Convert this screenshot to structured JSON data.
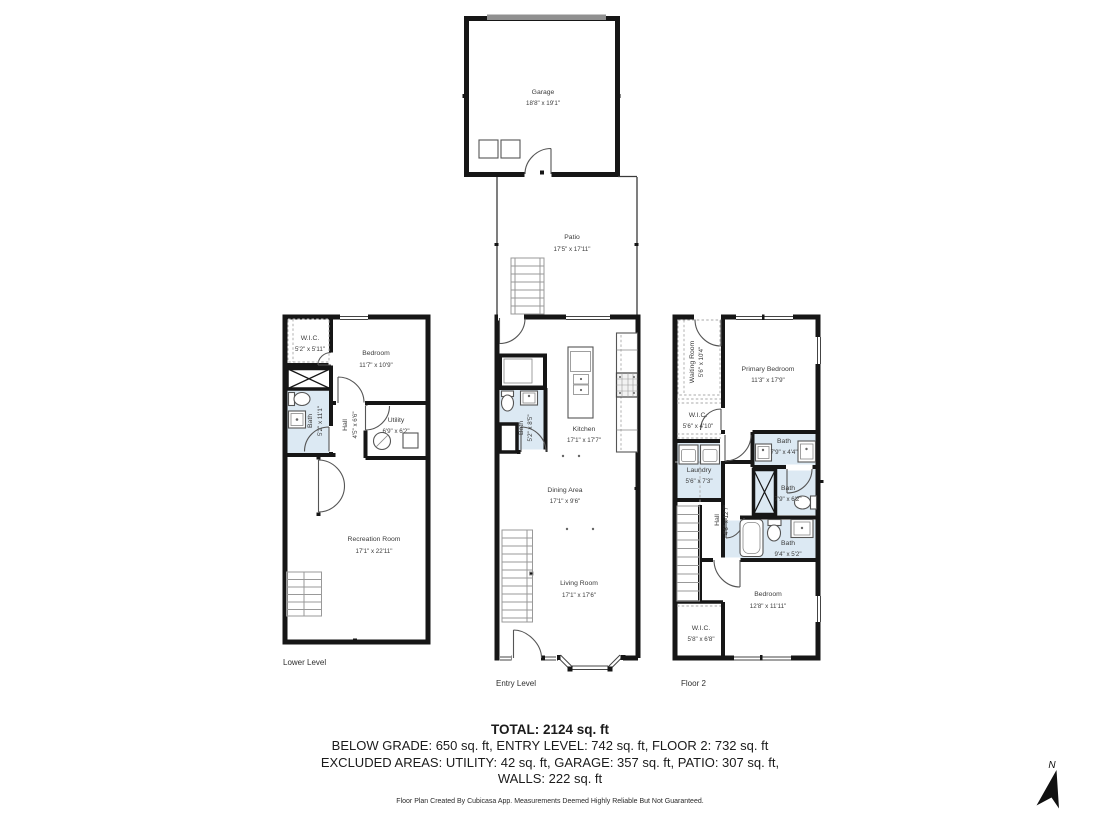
{
  "summary": {
    "total": "TOTAL: 2124 sq. ft",
    "levels_line": "BELOW GRADE: 650 sq. ft, ENTRY LEVEL: 742 sq. ft, FLOOR 2: 732 sq. ft",
    "excluded_line": "EXCLUDED AREAS: UTILITY: 42 sq. ft, GARAGE: 357 sq. ft, PATIO: 307 sq. ft,",
    "walls_line": "WALLS: 222 sq. ft"
  },
  "footer": "Floor Plan Created By Cubicasa App. Measurements Deemed Highly Reliable But Not Guaranteed.",
  "compass": {
    "label": "N"
  },
  "colors": {
    "wet_room_fill": "#dce9f3",
    "wall": "#161616",
    "garage_door": "#909090"
  },
  "levels": {
    "lower": {
      "label": "Lower Level",
      "rooms": {
        "wic": {
          "name": "W.I.C.",
          "dims": "5'2\" x 5'11\""
        },
        "bedroom": {
          "name": "Bedroom",
          "dims": "11'7\" x 10'9\""
        },
        "bath": {
          "name": "Bath",
          "dims": "5'2\" x 11'1\""
        },
        "hall": {
          "name": "Hall",
          "dims": "4'5\" x 6'6\""
        },
        "utility": {
          "name": "Utility",
          "dims": "6'9\" x 6'2\""
        },
        "recreation": {
          "name": "Recreation Room",
          "dims": "17'1\" x 22'11\""
        }
      }
    },
    "entry": {
      "label": "Entry Level",
      "rooms": {
        "garage": {
          "name": "Garage",
          "dims": "18'8\" x 19'1\""
        },
        "patio": {
          "name": "Patio",
          "dims": "17'5\" x 17'11\""
        },
        "bath": {
          "name": "Bath",
          "dims": "5'2\" x 8'5\""
        },
        "kitchen": {
          "name": "Kitchen",
          "dims": "17'1\" x 17'7\""
        },
        "dining": {
          "name": "Dining Area",
          "dims": "17'1\" x 9'6\""
        },
        "living": {
          "name": "Living Room",
          "dims": "17'1\" x 17'6\""
        }
      }
    },
    "floor2": {
      "label": "Floor 2",
      "rooms": {
        "waiting": {
          "name": "Waiting Room",
          "dims": "5'6\" x 10'4\""
        },
        "primary": {
          "name": "Primary Bedroom",
          "dims": "11'3\" x 17'9\""
        },
        "wic_upper": {
          "name": "W.I.C.",
          "dims": "5'6\" x 4'10\""
        },
        "laundry": {
          "name": "Laundry",
          "dims": "5'6\" x 7'3\""
        },
        "bath_top": {
          "name": "Bath",
          "dims": "7'9\" x 4'4\""
        },
        "bath_mid": {
          "name": "Bath",
          "dims": "7'9\" x 6'2\""
        },
        "bath_bottom": {
          "name": "Bath",
          "dims": "9'4\" x 5'2\""
        },
        "hall": {
          "name": "Hall",
          "dims": "4'6\" x 12'7\""
        },
        "bedroom": {
          "name": "Bedroom",
          "dims": "12'8\" x 11'11\""
        },
        "wic_lower": {
          "name": "W.I.C.",
          "dims": "5'8\" x 6'8\""
        }
      }
    }
  }
}
